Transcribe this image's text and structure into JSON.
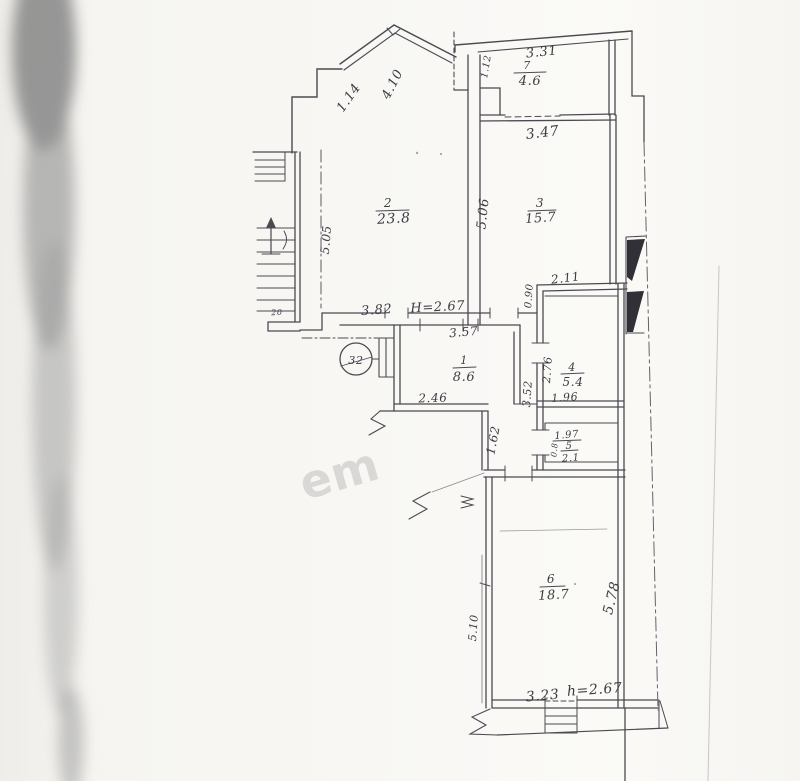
{
  "apartment": {
    "number_in_circle": "32"
  },
  "rooms": [
    {
      "number": "1",
      "area": "8.6"
    },
    {
      "number": "2",
      "area": "23.8"
    },
    {
      "number": "3",
      "area": "15.7"
    },
    {
      "number": "4",
      "area": "5.4"
    },
    {
      "number": "5",
      "area": "2.1"
    },
    {
      "number": "6",
      "area": "18.7"
    },
    {
      "number": "7",
      "area": "4.6"
    }
  ],
  "heights": {
    "capital_h": "H=2.67",
    "small_h": "h=2.67"
  },
  "dimensions": {
    "bay_left": "1.14",
    "bay_right": "4.10",
    "room7_width": "3.31",
    "room7_depth": "1.12",
    "room3_width_top": "3.47",
    "room2_height": "5.05",
    "room2_width_bottom": "3.82",
    "room3_height": "5.06",
    "room4_top": "2.11",
    "niche_depth": "0.90",
    "room1_width_top": "3.57",
    "room1_width_bottom": "2.46",
    "hall_length": "1.62",
    "corridor_length": "3.52",
    "room4_height": "2.76",
    "room4_width": "1.96",
    "room5_width": "1.97",
    "room5_depth": "0.8",
    "room6_height_right": "5.78",
    "room6_height_left": "5.10",
    "room6_width": "3.23",
    "stair_note": "20"
  },
  "watermark": "em",
  "colors": {
    "ink": "#4a4a52",
    "paper": "#f7f6f3"
  }
}
